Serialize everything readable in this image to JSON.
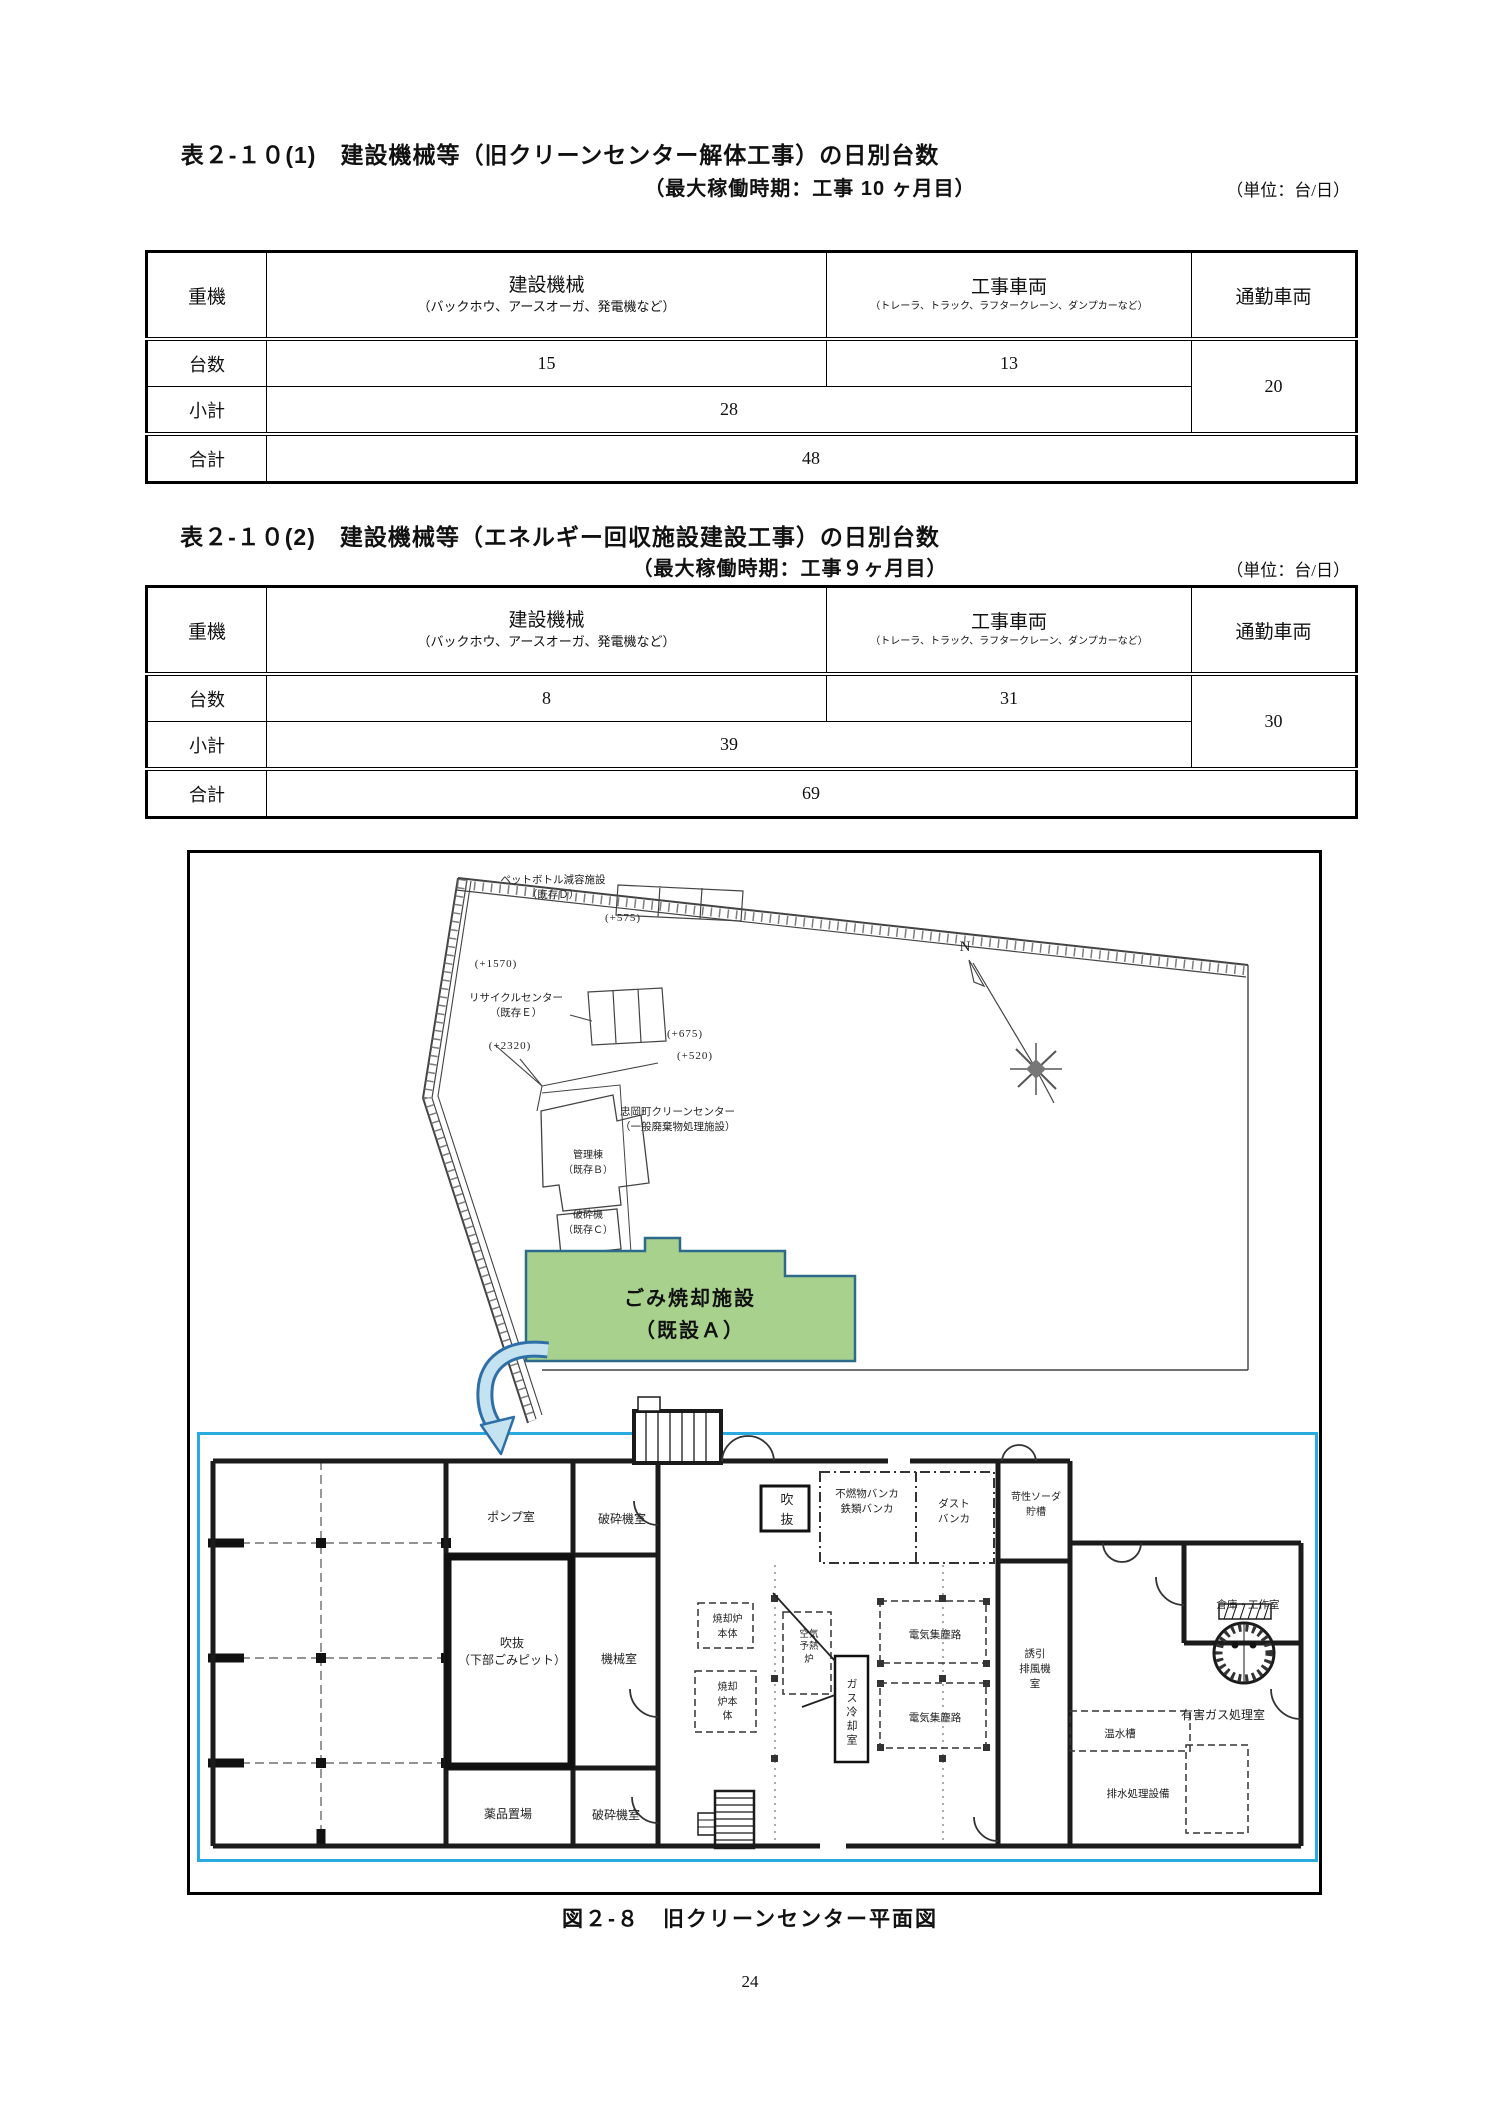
{
  "tables": [
    {
      "title": "表２-１０(1)　建設機械等（旧クリーンセンター解体工事）の日別台数",
      "subtitle": "（最大稼働時期：工事 10 ヶ月目）",
      "unit": "（単位：台/日）",
      "head": {
        "rowhdr": "重機",
        "c1": "建設機械",
        "c1_note": "（バックホウ、アースオーガ、発電機など）",
        "c2": "工事車両",
        "c2_note": "（トレーラ、トラック、ラフタークレーン、ダンプカーなど）",
        "c3": "通勤車両"
      },
      "rows": {
        "r1": "台数",
        "v_machines": "15",
        "v_vehicles": "13",
        "v_commute": "20",
        "r2": "小計",
        "subtotal": "28",
        "r3": "合計",
        "total": "48"
      }
    },
    {
      "title": "表２-１０(2)　建設機械等（エネルギー回収施設建設工事）の日別台数",
      "subtitle": "（最大稼働時期：工事９ヶ月目）",
      "unit": "（単位：台/日）",
      "head": {
        "rowhdr": "重機",
        "c1": "建設機械",
        "c1_note": "（バックホウ、アースオーガ、発電機など）",
        "c2": "工事車両",
        "c2_note": "（トレーラ、トラック、ラフタークレーン、ダンプカーなど）",
        "c3": "通勤車両"
      },
      "rows": {
        "r1": "台数",
        "v_machines": "8",
        "v_vehicles": "31",
        "v_commute": "30",
        "r2": "小計",
        "subtotal": "39",
        "r3": "合計",
        "total": "69"
      }
    }
  ],
  "figure": {
    "caption": "図２-８　旧クリーンセンター平面図",
    "site": {
      "north": "N",
      "pet_bottle": "ペットボトル減容施設\n（既存Ｄ）",
      "elev_575": "(+575)",
      "elev_1570": "(+1570)",
      "recycle": "リサイクルセンター\n（既存Ｅ）",
      "elev_675": "(+675)",
      "elev_2320": "(+2320)",
      "elev_520": "(+520)",
      "clean_center": "忠岡町クリーンセンター\n（一般廃棄物処理施設）",
      "admin": "管理棟\n（既存Ｂ）",
      "crusher": "破砕機\n（既存Ｃ）",
      "incinerator": "ごみ焼却施設\n（既設Ａ）"
    },
    "floor": {
      "pump": "ポンプ室",
      "crusher_top": "破砕機室",
      "atrium": "吹\n抜",
      "bunker": "不燃物バンカ\n鉄類バンカ",
      "dust": "ダスト\nバンカ",
      "soda": "苛性ソーダ\n貯槽",
      "warehouse": "倉庫・工作室",
      "pit": "吹抜\n（下部ごみピット）",
      "machine": "機械室",
      "furnace_upper": "焼却炉\n本体",
      "furnace_lower": "焼却\n炉本\n体",
      "preheater": "空気\n予熱\n炉",
      "gas_cooling": "ガス冷却室",
      "ep_upper": "電気集塵路",
      "ep_lower": "電気集塵路",
      "induced_fan": "誘引\n排風機\n室",
      "hot_water": "温水槽",
      "toxic_gas": "有害ガス処理室",
      "drainage": "排水処理設備",
      "chemical": "薬品置場",
      "crusher_bottom": "破砕機室"
    }
  },
  "page": {
    "number": "24"
  }
}
